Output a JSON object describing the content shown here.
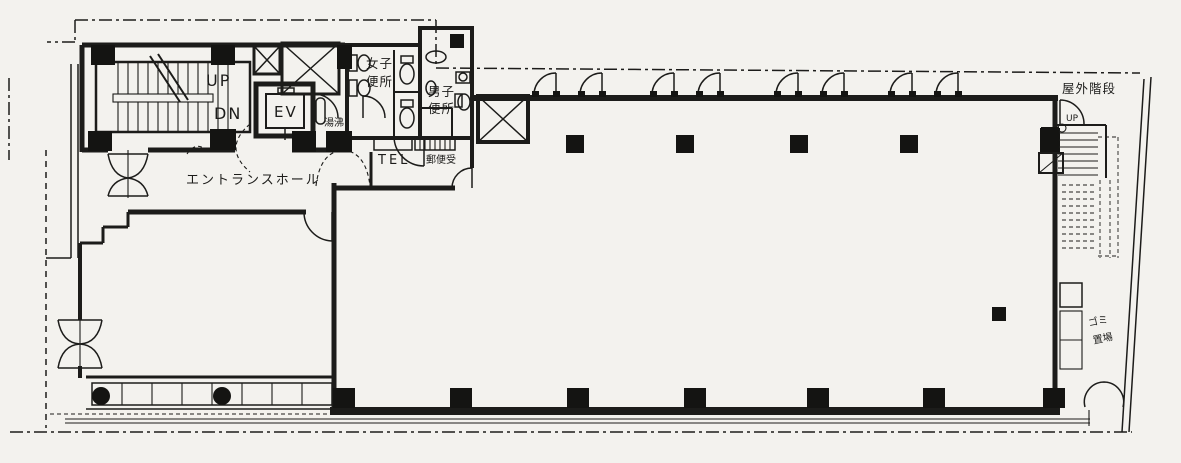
{
  "colors": {
    "paper": "#f3f2ee",
    "ink": "#1c1c1a"
  },
  "rooms": {
    "entrance_hall": "エントランスホール",
    "womens_toilet_line1": "女子",
    "womens_toilet_line2": "便所",
    "mens_toilet_line1": "男子",
    "mens_toilet_line2": "便所",
    "hot_water": "湯沸",
    "garbage_line1": "ゴミ",
    "garbage_line2": "置場"
  },
  "stairs": {
    "up": "UP",
    "down": "DN",
    "outdoor": "屋外階段",
    "outdoor_up": "UP"
  },
  "equipment": {
    "elevator": "EV",
    "telephone": "TEL",
    "mailbox": "郵便受"
  }
}
